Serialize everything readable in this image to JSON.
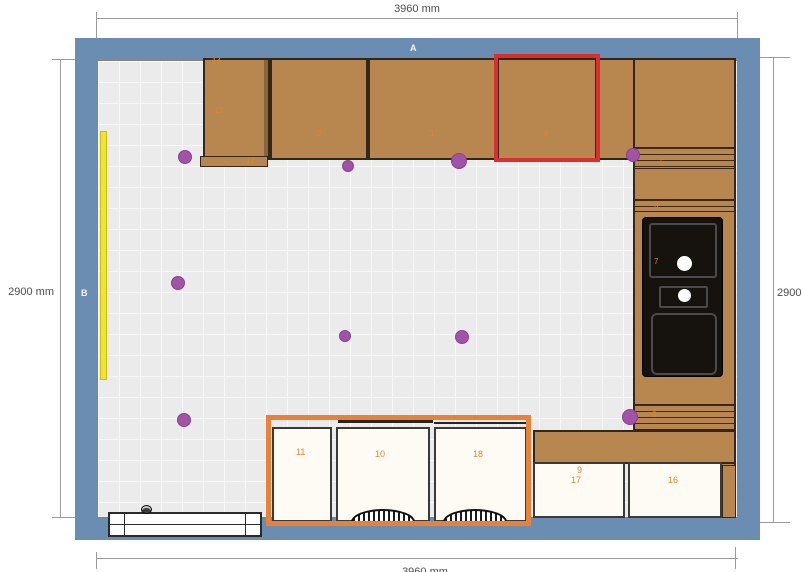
{
  "scene": "kitchen-floor-plan",
  "dimensions": {
    "top": "3960 mm",
    "left": "2900 mm",
    "right": "2900",
    "bottom": "3960 mm"
  },
  "wall_labels": {
    "top": "A",
    "left": "B"
  },
  "cabinet_numbers": {
    "tall": {
      "top": "14",
      "mid": "13",
      "bottom": "12"
    },
    "wall_row": [
      "2",
      "1",
      "4"
    ],
    "right_run": {
      "upper": "5",
      "mid": "6",
      "sink": "7",
      "lower": "8"
    },
    "base_right": {
      "a_top": "9",
      "a": "17",
      "b": "16"
    },
    "island": [
      "11",
      "10",
      "18"
    ]
  },
  "colors": {
    "wall": "#6b8db2",
    "floor": "#ebebeb",
    "cabinet": "#b8864f",
    "selection_red": "#d8302f",
    "selection_orange": "#e8823b",
    "light_purple": "#a153a8",
    "window_yellow": "#f4e32c",
    "appliance_black": "#16120e",
    "number_orange": "#d9882f"
  }
}
